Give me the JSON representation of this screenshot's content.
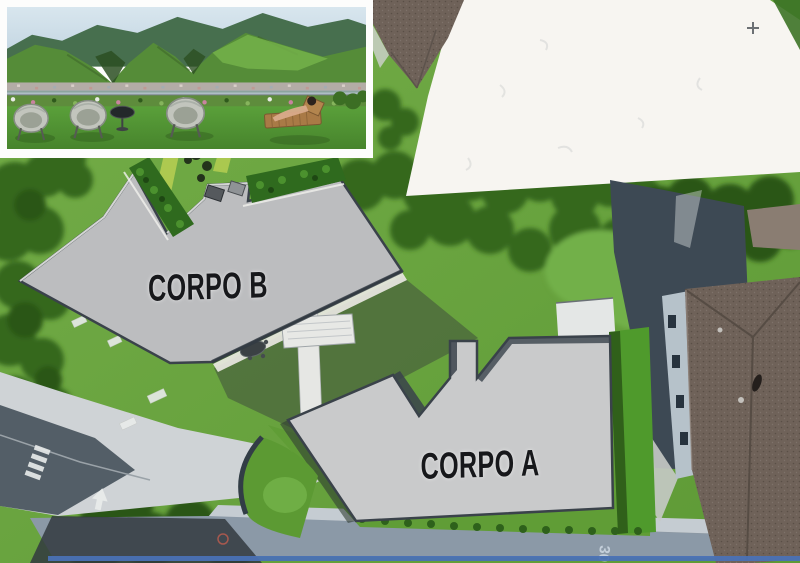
{
  "site_plan": {
    "building_b_label": "CORPO B",
    "building_a_label": "CORPO A",
    "road_speed_marking": "30"
  },
  "colors": {
    "label_text": "#17181b",
    "building_fill_a": "#c9cacb",
    "building_fill_b": "#bcbdbf",
    "building_outline": "#3a424a",
    "lawn_green": "#69a43e",
    "tree_green": "#35681f",
    "hedge_green": "#4f9a2c",
    "plaza_gray": "#cfd3d6",
    "road_gray": "#8b99a7",
    "white_overlay": "#f7f5f1",
    "roof_brown": "#6f6259",
    "shadow_slate": "#3d4954",
    "bottom_edge_blue": "#4a71b5"
  }
}
